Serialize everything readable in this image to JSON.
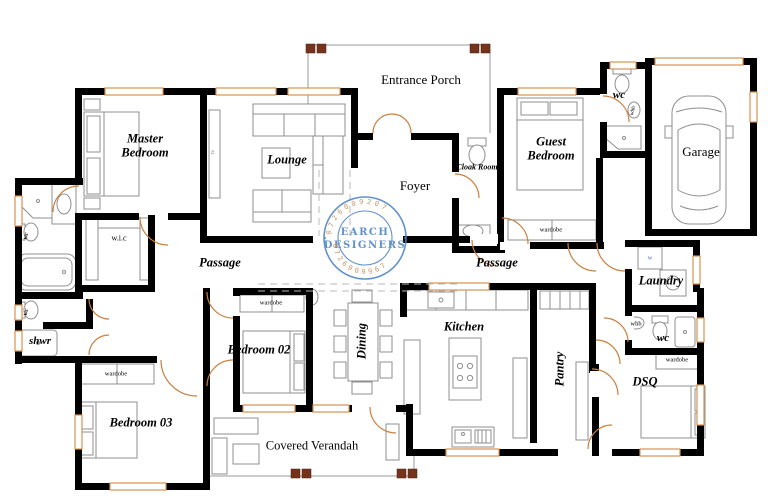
{
  "colors": {
    "background": "#ffffff",
    "wall": "#000000",
    "window": "#d89252",
    "door": "#c9803e",
    "column": "#76331b",
    "furniture": "#8f8f8f",
    "dash": "#b8b8b8",
    "stamp_blue": "#4d84c6",
    "stamp_orange": "#c58044"
  },
  "stamp": {
    "line1": "EARCH",
    "line2": "DESIGNERS",
    "phone_top": "0726009207",
    "phone_bottom": "0726009967",
    "dot_left": "•",
    "dot_right": "•"
  },
  "labels": [
    {
      "name": "room-label-master-bedroom",
      "text": "Master Bedroom",
      "x": 145,
      "y": 146,
      "cls": "rm",
      "w": 76
    },
    {
      "name": "room-label-lounge",
      "text": "Lounge",
      "x": 287,
      "y": 160,
      "cls": "rm"
    },
    {
      "name": "room-label-entrance-porch",
      "text": "Entrance Porch",
      "x": 421,
      "y": 80,
      "cls": "plain",
      "w": 88
    },
    {
      "name": "room-label-foyer",
      "text": "Foyer",
      "x": 415,
      "y": 186,
      "cls": "plain"
    },
    {
      "name": "room-label-cloak-room",
      "text": "Cloak Room",
      "x": 477,
      "y": 168,
      "cls": "rmXS",
      "w": 44
    },
    {
      "name": "room-label-guest-bedroom",
      "text": "Guest Bedroom",
      "x": 551,
      "y": 149,
      "cls": "rm",
      "w": 80
    },
    {
      "name": "room-label-wc-guest-ensuite",
      "text": "wc",
      "x": 619,
      "y": 96,
      "cls": "rmS"
    },
    {
      "name": "room-label-garage",
      "text": "Garage",
      "x": 701,
      "y": 152,
      "cls": "plain"
    },
    {
      "name": "room-label-passage-west",
      "text": "Passage",
      "x": 220,
      "y": 263,
      "cls": "rm"
    },
    {
      "name": "room-label-passage-east",
      "text": "Passage",
      "x": 497,
      "y": 263,
      "cls": "rm"
    },
    {
      "name": "room-label-wic",
      "text": "w.i.c",
      "x": 119,
      "y": 239,
      "cls": "tiny2"
    },
    {
      "name": "room-label-laundry",
      "text": "Laundry",
      "x": 661,
      "y": 281,
      "cls": "rm"
    },
    {
      "name": "room-label-shwr",
      "text": "shwr",
      "x": 40,
      "y": 342,
      "cls": "rmS"
    },
    {
      "name": "fixture-label-wc-ensuite",
      "text": "wc",
      "x": 26,
      "y": 236,
      "cls": "rot75"
    },
    {
      "name": "fixture-label-wc-bath2",
      "text": "wc",
      "x": 26,
      "y": 312,
      "cls": "rot75"
    },
    {
      "name": "room-label-bedroom-02",
      "text": "Bedroom 02",
      "x": 259,
      "y": 350,
      "cls": "rm",
      "w": 70
    },
    {
      "name": "room-label-bedroom-03",
      "text": "Bedroom 03",
      "x": 141,
      "y": 423,
      "cls": "rm",
      "w": 70
    },
    {
      "name": "room-label-dining",
      "text": "Dining",
      "x": 362,
      "y": 341,
      "cls": "rm rot"
    },
    {
      "name": "room-label-kitchen",
      "text": "Kitchen",
      "x": 464,
      "y": 327,
      "cls": "rm"
    },
    {
      "name": "room-label-pantry",
      "text": "Pantry",
      "x": 560,
      "y": 369,
      "cls": "rm rot"
    },
    {
      "name": "room-label-dsq",
      "text": "DSQ",
      "x": 645,
      "y": 382,
      "cls": "rm"
    },
    {
      "name": "room-label-covered-verandah",
      "text": "Covered Verandah",
      "x": 312,
      "y": 446,
      "cls": "plainS",
      "w": 100
    },
    {
      "name": "room-label-wc-east",
      "text": "wc",
      "x": 663,
      "y": 339,
      "cls": "rmS"
    },
    {
      "name": "fixture-label-wardrobe-guest",
      "text": "wardobe",
      "x": 551,
      "y": 230,
      "cls": "tiny"
    },
    {
      "name": "fixture-label-wardrobe-bedroom02",
      "text": "wardobe",
      "x": 271,
      "y": 303,
      "cls": "tiny"
    },
    {
      "name": "fixture-label-wardrobe-bedroom03",
      "text": "wardobe",
      "x": 116,
      "y": 374,
      "cls": "tiny"
    },
    {
      "name": "fixture-label-wardrobe-dsq",
      "text": "wardobe",
      "x": 677,
      "y": 360,
      "cls": "tiny"
    },
    {
      "name": "fixture-label-whb-bedroom02",
      "text": "whb",
      "x": 312,
      "y": 297,
      "cls": "rot75t"
    },
    {
      "name": "fixture-label-whb-guest-wc",
      "text": "whb",
      "x": 634,
      "y": 111,
      "cls": "rot75t"
    },
    {
      "name": "fixture-label-whb-east-wc",
      "text": "whb",
      "x": 636,
      "y": 324,
      "cls": "tiny"
    },
    {
      "name": "fixture-label-washer",
      "text": "w",
      "x": 650,
      "y": 258,
      "cls": "tinyB"
    },
    {
      "name": "fixture-label-tv",
      "text": "tv",
      "x": 214,
      "y": 152,
      "cls": "rot90t"
    }
  ]
}
